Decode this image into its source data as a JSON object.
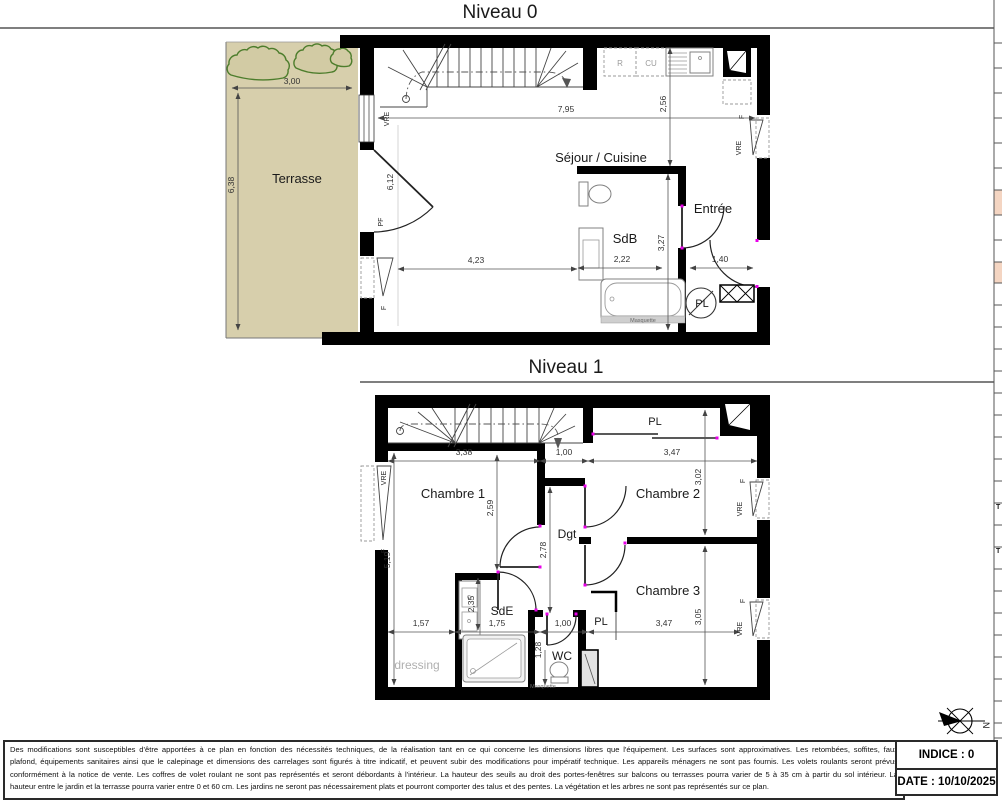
{
  "level0": {
    "title": "Niveau 0",
    "rooms": {
      "terrasse": "Terrasse",
      "sejour": "Séjour / Cuisine",
      "sdb": "SdB",
      "entree": "Entrée"
    },
    "fixtures": {
      "fridge": "R",
      "cooktop": "CU",
      "pl": "PL",
      "tub_mask": "Masquette"
    },
    "windows": {
      "left_vre": "VRE",
      "left_pf": "PF",
      "left_f": "F",
      "right_f": "F",
      "right_vre": "VRE"
    },
    "dims": {
      "terrace_w": "3,00",
      "terrace_h": "6,38",
      "total_w": "7,95",
      "kitchen_d": "2,56",
      "left_h": "6,12",
      "sejour_w": "4,23",
      "sdb_w": "2,22",
      "sdb_h": "3,27",
      "entree_w": "1,40"
    }
  },
  "level1": {
    "title": "Niveau 1",
    "rooms": {
      "ch1": "Chambre 1",
      "ch2": "Chambre 2",
      "ch3": "Chambre 3",
      "dgt": "Dgt",
      "sde": "SdE",
      "wc": "WC",
      "dressing": "dressing"
    },
    "fixtures": {
      "pl_top": "PL",
      "pl3": "PL",
      "shower_mask": "Masquette"
    },
    "windows": {
      "left_vre": "VRE",
      "left_f": "F",
      "ch2_f": "F",
      "ch2_vre": "VRE",
      "ch3_f": "F",
      "ch3_vre": "VRE"
    },
    "dims": {
      "ch1_w": "3,38",
      "hall_w": "1,00",
      "ch2_w": "3,47",
      "ch2_h": "3,02",
      "left_h": "5,19",
      "ch1_h": "2,59",
      "dgt_h": "2,78",
      "sde_d": "2,35",
      "dressing_w": "1,57",
      "sde_w": "1,75",
      "wc_w": "1,00",
      "wc_h": "1,28",
      "ch3_w": "3,47",
      "ch3_h": "3,05"
    }
  },
  "footer": {
    "disclaimer_lines": [
      "Des modifications sont susceptibles d'être apportées à ce plan en fonction des nécessités techniques, de la réalisation tant en ce qui concerne les dimensions libres que l'équipement. Les surfaces sont approximatives. Les retombées, soffites, faux",
      "plafond, équipements sanitaires ainsi que le calepinage et dimensions des carrelages sont figurés à titre indicatif, et peuvent subir des modifications pour impératif technique. Les appareils ménagers ne sont pas fournis. Les volets roulants seront prévus",
      "conformément à la notice de vente. Les coffres de volet roulant ne sont pas représentés et seront débordants à l'intérieur. La hauteur des seuils au droit des portes-fenêtres sur balcons ou terrasses pourra varier de 5 à 35 cm à partir du sol intérieur. La",
      "hauteur entre le jardin et la terrasse pourra varier entre 0 et 60 cm. Les jardins ne seront pas nécessairement plats et pourront comporter des talus et des pentes. La végétation et les arbres ne sont pas représentés sur ce plan."
    ],
    "indice": "INDICE : 0",
    "date": "DATE : 10/10/2025",
    "north": "N"
  },
  "side": {
    "t_top": "T",
    "t_bottom": "T"
  },
  "colors": {
    "terrace": "#d7cfac",
    "bush": "#4d7d2c",
    "salmon": "#f4d5c2"
  }
}
